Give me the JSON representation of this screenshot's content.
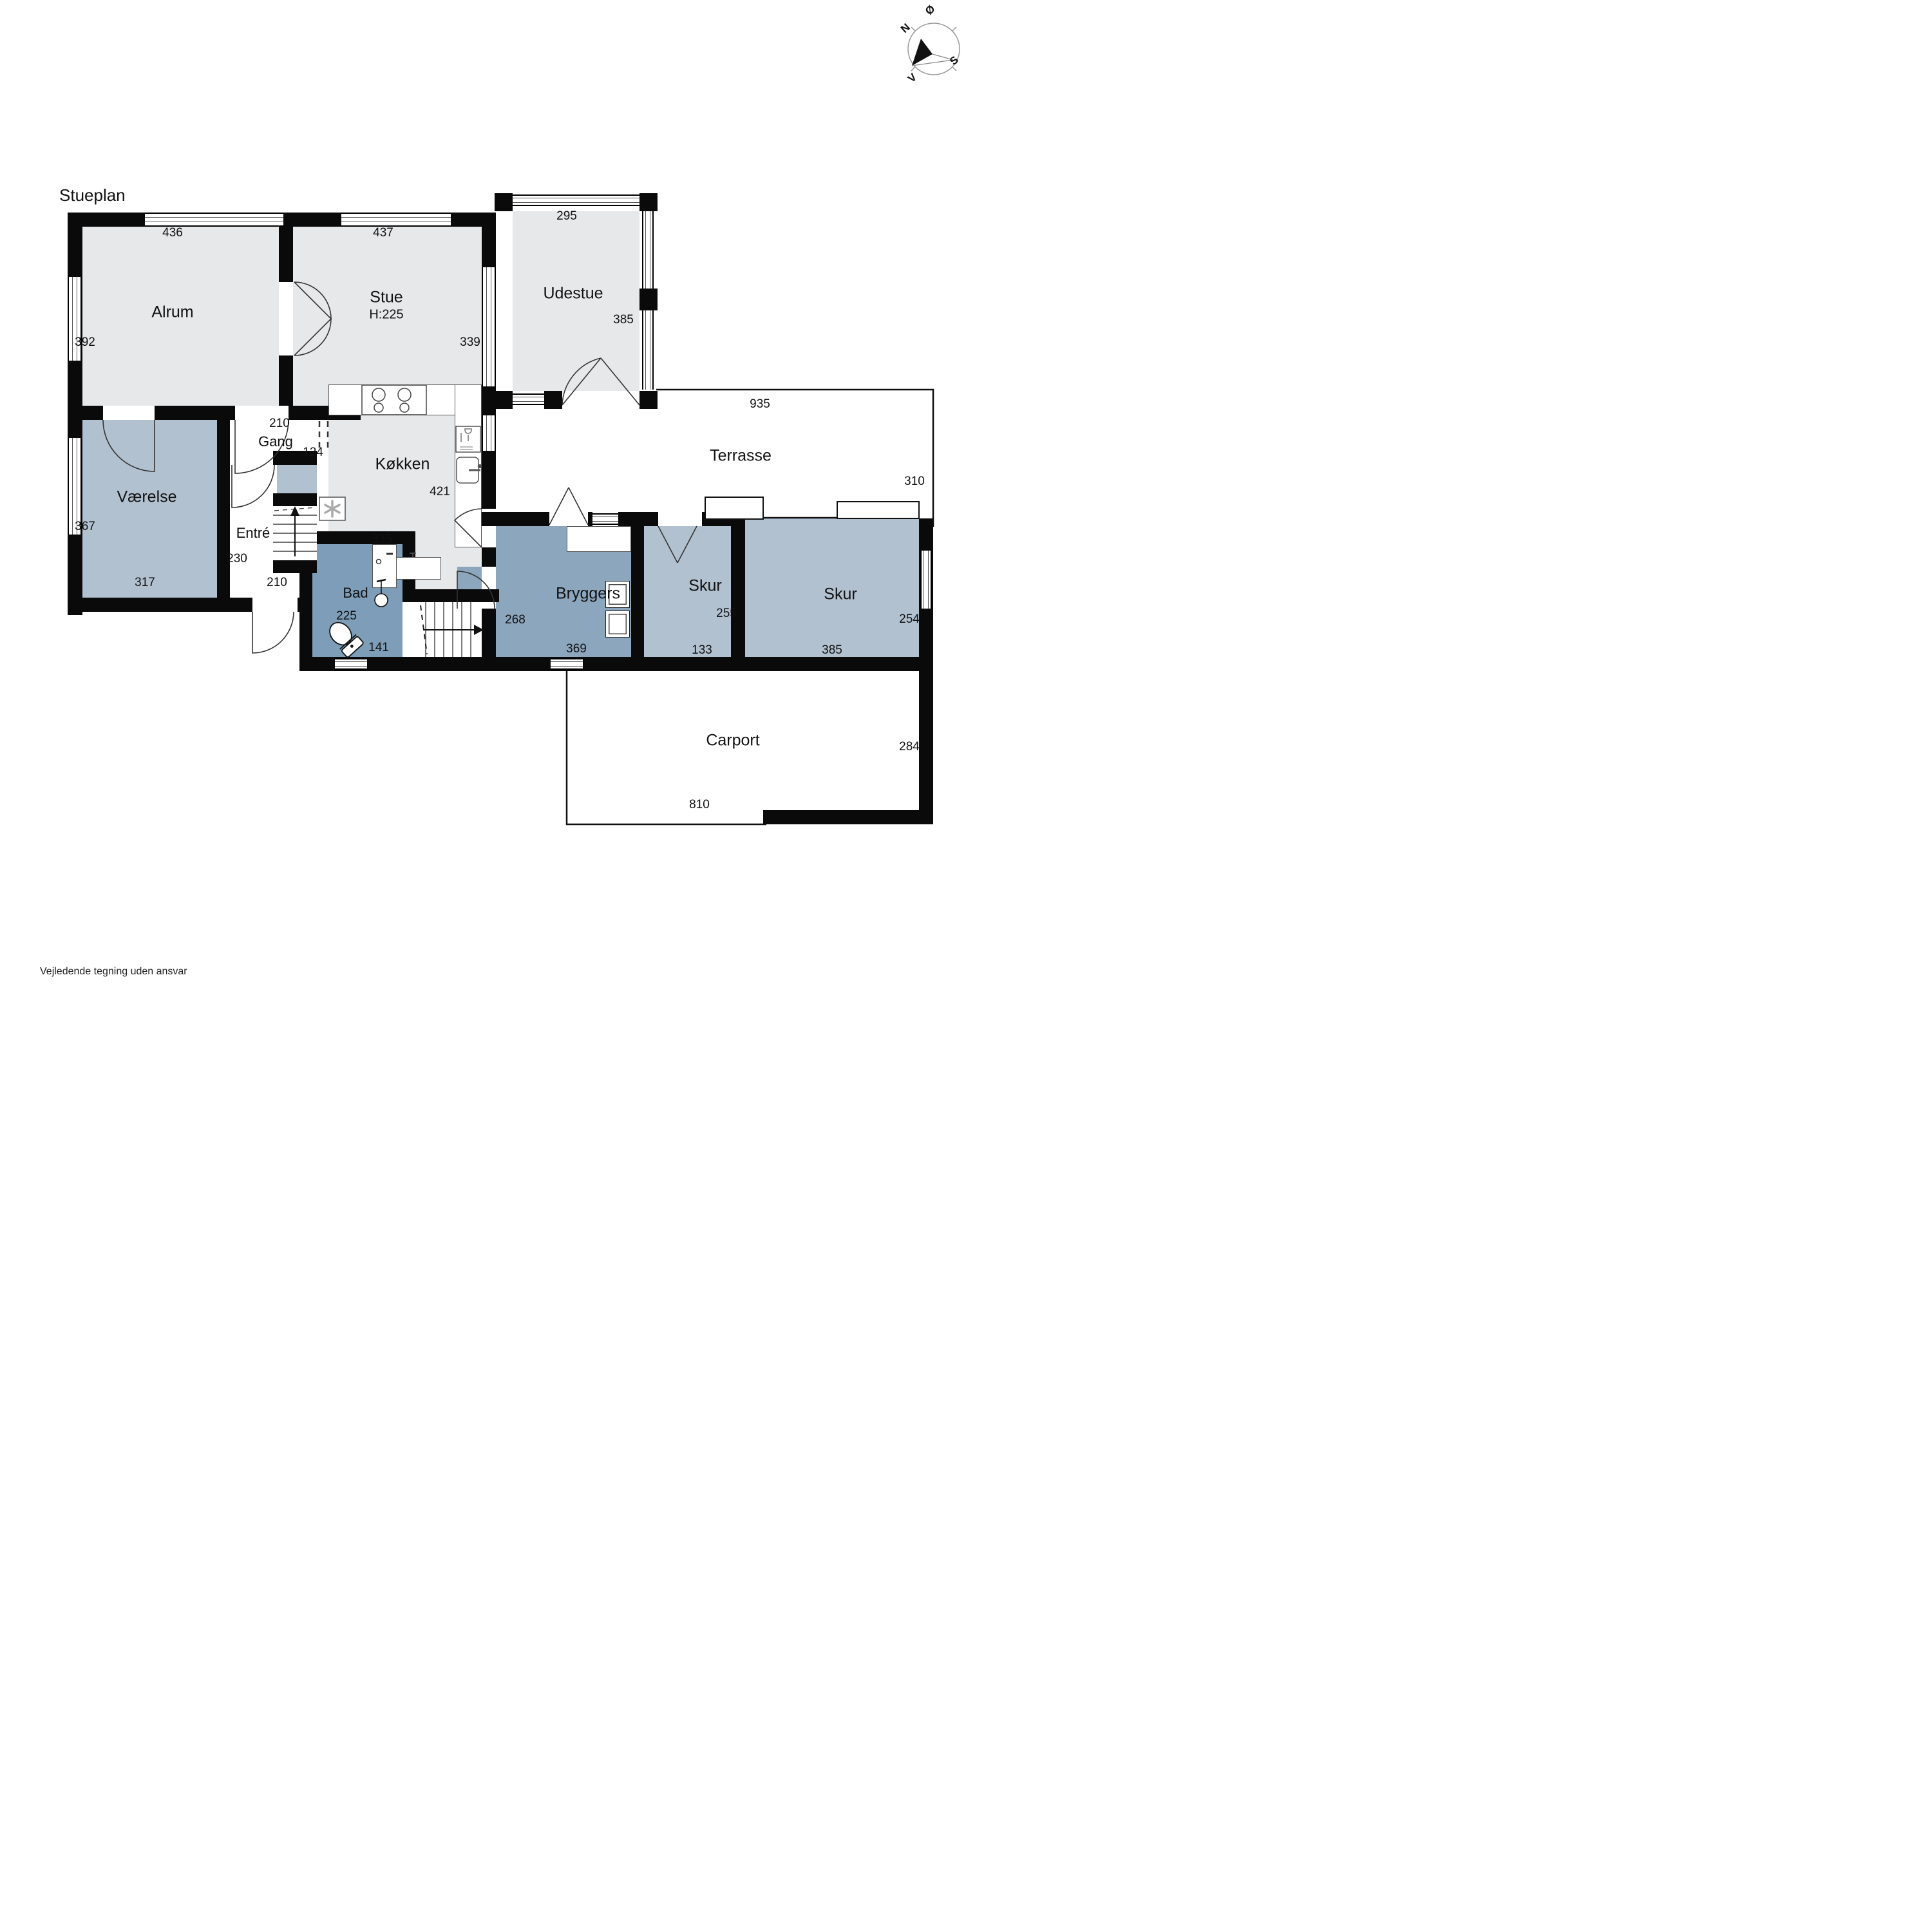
{
  "title": "Stueplan",
  "disclaimer": "Vejledende tegning uden ansvar",
  "compass": {
    "n": "N",
    "e": "Ø",
    "s": "S",
    "w": "V"
  },
  "colors": {
    "wall": "#0a0a0a",
    "room_light": "#e7e8ea",
    "room_blue_light": "#b2c1d0",
    "room_blue_medium": "#8ba6bd",
    "room_bad": "#7e9db8"
  },
  "rooms": {
    "alrum": {
      "label": "Alrum",
      "width": "436",
      "depth": "392"
    },
    "stue": {
      "label": "Stue",
      "ceiling": "H:225",
      "width": "437",
      "depth": "339"
    },
    "udestue": {
      "label": "Udestue",
      "width": "295",
      "depth": "385"
    },
    "gang": {
      "label": "Gang",
      "width": "210",
      "opening": "124"
    },
    "vaerelse": {
      "label": "Værelse",
      "depth": "367",
      "width": "317"
    },
    "entre": {
      "label": "Entré",
      "depth": "230",
      "door": "210"
    },
    "koekken": {
      "label": "Køkken",
      "depth": "421",
      "width": "335"
    },
    "terrasse": {
      "label": "Terrasse",
      "width": "935",
      "depth": "310"
    },
    "bad": {
      "label": "Bad",
      "depth": "225",
      "width": "141"
    },
    "bryggers": {
      "label": "Bryggers",
      "entry": "268",
      "width": "369"
    },
    "skur1": {
      "label": "Skur",
      "depth": "255",
      "width": "133"
    },
    "skur2": {
      "label": "Skur",
      "width": "385",
      "depth": "254"
    },
    "carport": {
      "label": "Carport",
      "depth": "284",
      "width": "810"
    }
  }
}
